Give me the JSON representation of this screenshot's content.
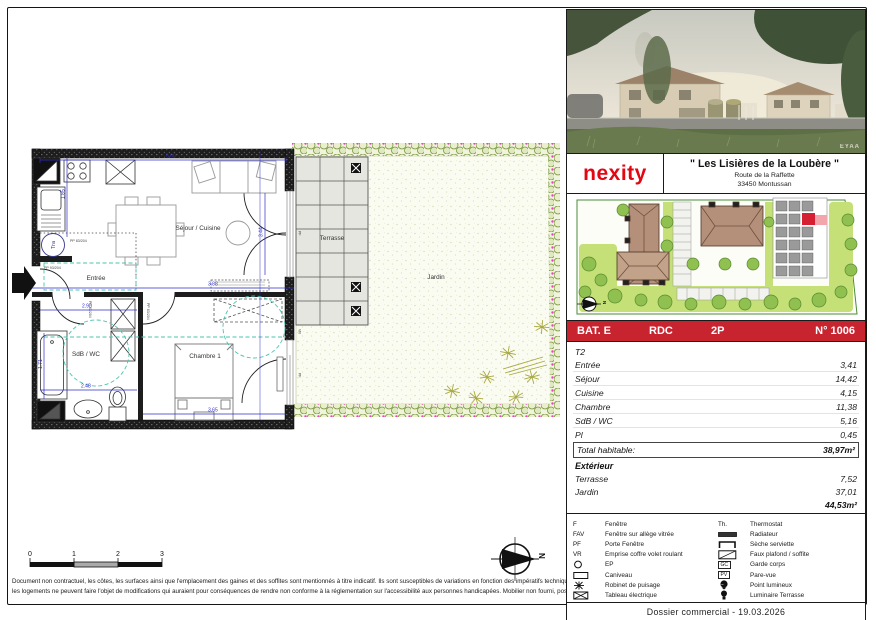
{
  "panel": {
    "photo": {
      "watermark": "EYAA"
    },
    "brand": "nexity",
    "title": "\" Les Lisières de la Loubère \"",
    "address1": "Route de la Raffette",
    "address2": "33450 Montussan",
    "unit": {
      "bat": "BAT. E",
      "floor": "RDC",
      "type": "2P",
      "num": "N° 1006"
    },
    "areas": {
      "type": "T2",
      "rows": [
        {
          "label": "Entrée",
          "value": "3,41"
        },
        {
          "label": "Séjour",
          "value": "14,42"
        },
        {
          "label": "Cuisine",
          "value": "4,15"
        },
        {
          "label": "Chambre",
          "value": "11,38"
        },
        {
          "label": "SdB / WC",
          "value": "5,16"
        },
        {
          "label": "Pl",
          "value": "0,45"
        }
      ],
      "total_label": "Total habitable:",
      "total_value": "38,97m²",
      "ext_title": "Extérieur",
      "ext_rows": [
        {
          "label": "Terrasse",
          "value": "7,52"
        },
        {
          "label": "Jardin",
          "value": "37,01"
        }
      ],
      "ext_total": "44,53m²"
    },
    "legend": {
      "left": [
        {
          "sym": "F",
          "label": "Fenêtre"
        },
        {
          "sym": "FAV",
          "label": "Fenêtre sur allège vitrée"
        },
        {
          "sym": "PF",
          "label": "Porte Fenêtre"
        },
        {
          "sym": "VR",
          "label": "Emprise coffre volet roulant"
        },
        {
          "sym": "",
          "label": "EP"
        },
        {
          "sym": "",
          "label": "Caniveau"
        },
        {
          "sym": "",
          "label": "Robinet de puisage"
        },
        {
          "sym": "",
          "label": "Tableau électrique"
        }
      ],
      "right": [
        {
          "sym": "Th.",
          "label": "Thermostat"
        },
        {
          "sym": "",
          "label": "Radiateur"
        },
        {
          "sym": "",
          "label": "Sèche serviette"
        },
        {
          "sym": "",
          "label": "Faux plafond / soffite"
        },
        {
          "sym": "GC",
          "label": "Garde corps"
        },
        {
          "sym": "PV",
          "label": "Pare-vue"
        },
        {
          "sym": "",
          "label": "Point lumineux"
        },
        {
          "sym": "",
          "label": "Luminaire Terrasse"
        }
      ]
    },
    "footer": "Dossier commercial  -  19.03.2026"
  },
  "plan": {
    "rooms": {
      "sejour": "Séjour / Cuisine",
      "entree": "Entrée",
      "sdb": "SdB / WC",
      "chambre": "Chambre 1",
      "terrasse": "Terrasse",
      "jardin": "Jardin"
    },
    "annotations": {
      "tra": "Tra",
      "pp_entry": "PP 93/204",
      "pp_int": "PP 83/204",
      "vr": "VR",
      "pf": "PF"
    },
    "dims": {
      "d560": "5.60",
      "d185": "1.85",
      "d344": "3.44",
      "d388": "3.88",
      "d290": "2.90",
      "d248": "2.48",
      "d171": "1.71",
      "d365": "3.65"
    },
    "compass_letter": "N",
    "scalebar": [
      "0",
      "1",
      "2",
      "3"
    ]
  },
  "disclaimer": {
    "line1": "Document non contractuel, les côtes, les surfaces ainsi que l'emplacement des gaines et des soffites sont mentionnés à titre indicatif. Ils sont susceptibles de variations en fonction des impératifs techniques ou administratifs.",
    "line2": "les logements ne peuvent faire l'objet de modifications qui auraient pour conséquences de rendre non conforme à la réglementation sur l'accessibilité aux personnes handicapées. Mobilier non fourni, positionné à titre indicatif"
  },
  "colors": {
    "brand_red": "#e30613",
    "bar_red": "#c8242f",
    "dim_blue": "#2e2ec8",
    "accessibility_teal": "#4cc3ae",
    "hedge_green": "#79943f",
    "hedge_pink": "#ee3fbf",
    "site_unit_red": "#d42032"
  }
}
